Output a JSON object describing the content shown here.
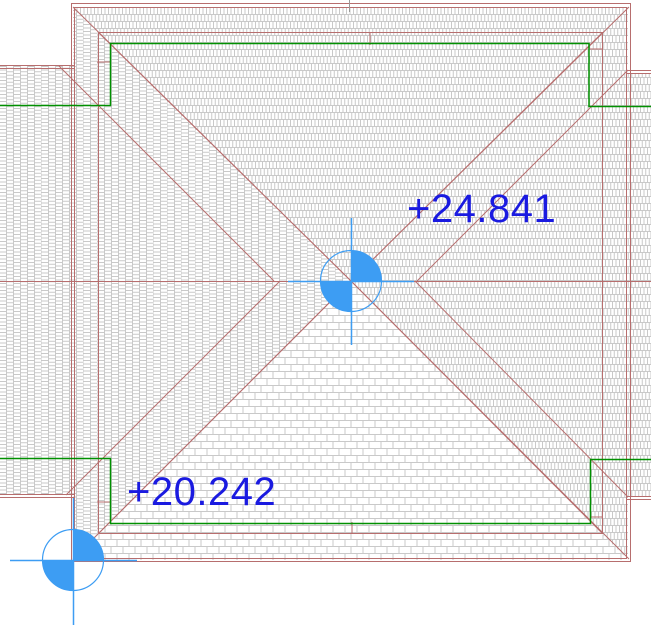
{
  "drawing": {
    "view_label": "roof-plan",
    "annotations": {
      "upper_level": {
        "label": "+24.841"
      },
      "lower_level": {
        "label": "+20.242"
      }
    },
    "symbols": {
      "upper_survey_point": "survey-point-quartered-circle",
      "lower_survey_point": "survey-point-quartered-circle"
    },
    "colors": {
      "annotation_text": "#1a1ae0",
      "symbol_blue": "#3d9df3",
      "roof_line": "#b76e6e",
      "wall_line_green": "#009000",
      "hatch_gray": "#c9c9c9",
      "background": "#ffffff"
    }
  }
}
